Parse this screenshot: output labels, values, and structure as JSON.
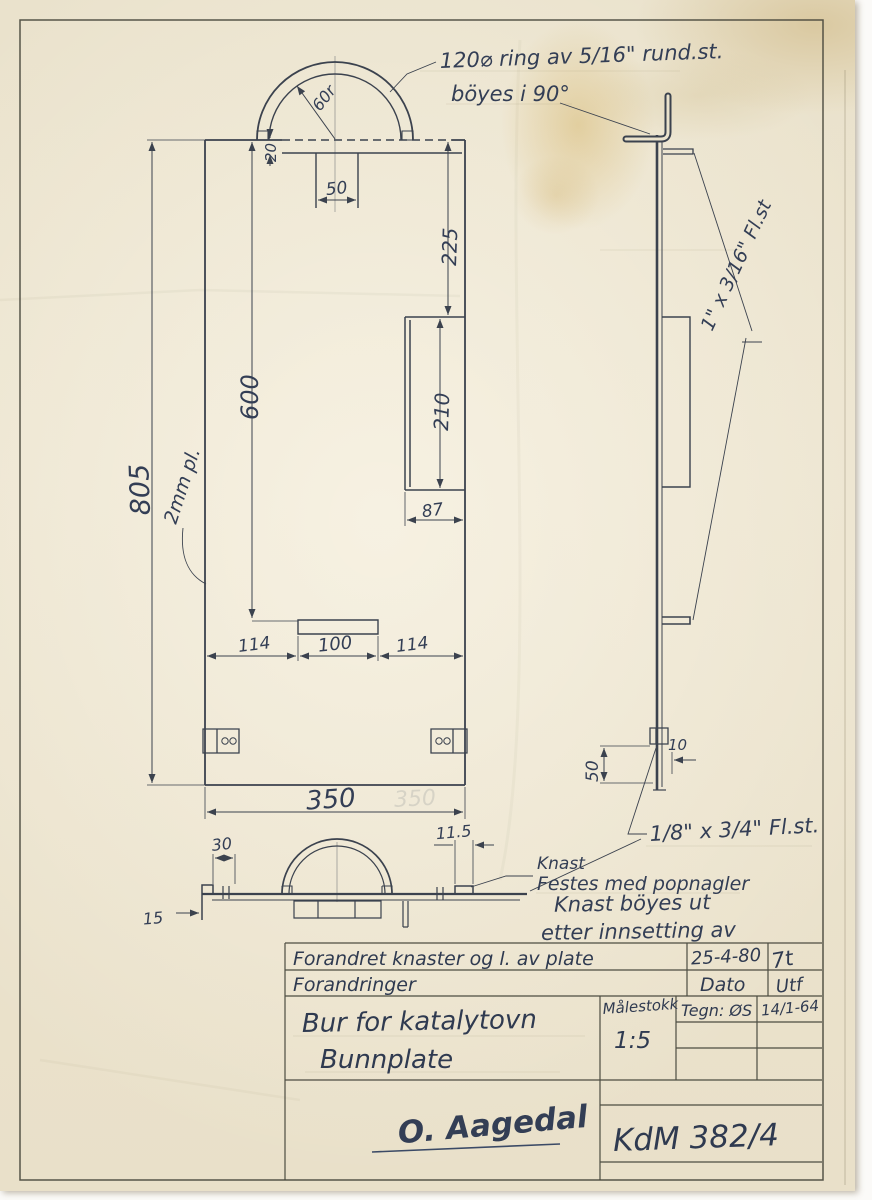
{
  "sheet": {
    "notes": {
      "ring_line1": "120⌀ ring av 5/16\" rund.st.",
      "ring_line2": "böyes i 90°",
      "plate_material": "2mm pl.",
      "side_flat_steel": "1\" x 3/16\" Fl.st",
      "bottom_flat_steel": "1/8\" x 3/4\" Fl.st.",
      "knast": "Knast",
      "knast_fastening": "Festes med popnagler",
      "erased_line1": "Knast böyes ut",
      "erased_line2": "etter innsetting av"
    },
    "dims": {
      "front": {
        "height": "805",
        "inner_height": "600",
        "width": "350",
        "width_ghost": "350",
        "top_to_slot": "225",
        "slot_height": "210",
        "slot_width": "87",
        "seg_left": "114",
        "seg_mid": "100",
        "seg_right": "114",
        "ring_tab_width": "50",
        "ring_drop": "20",
        "ring_radius": "60r"
      },
      "side": {
        "knast_height": "50",
        "knast_offset": "10"
      },
      "bottom": {
        "knast_width": "30",
        "knast_lip": "15",
        "edge_offset": "11.5"
      }
    },
    "title_block": {
      "change_note": "Forandret knaster og l. av plate",
      "change_date": "25-4-80",
      "change_sign": "7t",
      "revisions_label": "Forandringer",
      "date_label": "Dato",
      "done_label": "Utf",
      "title_line1": "Bur for katalytovn",
      "title_line2": "Bunnplate",
      "scale_label": "Målestokk",
      "scale_value": "1:5",
      "drawn_by": "Tegn: ØS",
      "drawn_date": "14/1-64",
      "signature": "O. Aagedal",
      "drawing_no": "KdM 382/4"
    }
  }
}
